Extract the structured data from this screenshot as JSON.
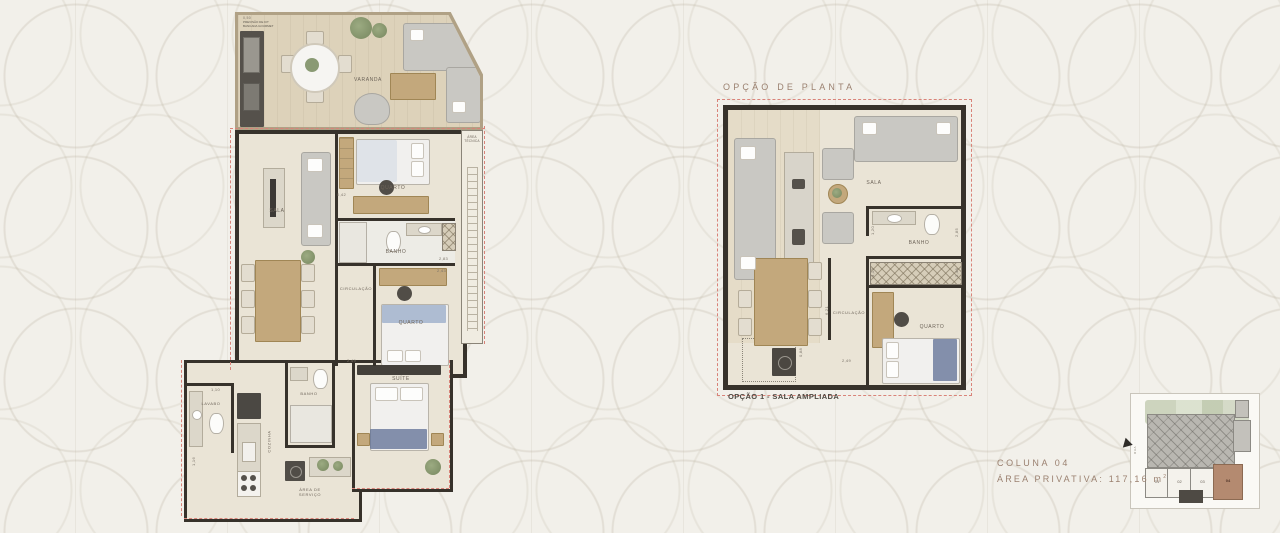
{
  "colors": {
    "background": "#f2f0ea",
    "wall": "#37322b",
    "floor": "#eae4d6",
    "deck": "#ddd2ba",
    "dashed_boundary": "#d98379",
    "furniture_gray": "#c9c8c3",
    "wood": "#c3a87c",
    "title_text": "#9b8170",
    "caption_text": "#4f4a43",
    "site_highlight": "#b48a70",
    "bed_accent": "#5d6f94",
    "plant_green": "#8a9a74"
  },
  "header": {
    "option_title": "OPÇÃO DE PLANTA"
  },
  "left_plan": {
    "note_dimension": "0,50",
    "note_line1": "PREVISÃO DE KIT",
    "note_line2": "BANCADA GOURMET",
    "rooms": {
      "varanda": "VARANDA",
      "sala": "SALA",
      "quarto1": "QUARTO",
      "banho1": "BANHO",
      "area_tecnica_line1": "ÁREA",
      "area_tecnica_line2": "TÉCNICA",
      "circulacao": "CIRCULAÇÃO",
      "quarto2": "QUARTO",
      "suite": "SUÍTE",
      "lavabo": "LAVABO",
      "cozinha": "COZINHA",
      "banho2": "BANHO",
      "area_servico_line1": "ÁREA DE",
      "area_servico_line2": "SERVIÇO"
    },
    "dimensions": {
      "d1": "0,42",
      "d2": "2,43",
      "d3": "2,49",
      "d4": "1,10",
      "d5": "1,16",
      "d6": "2,83"
    }
  },
  "right_plan": {
    "caption": "OPÇÃO 1 - SALA AMPLIADA",
    "rooms": {
      "sala": "SALA",
      "banho": "BANHO",
      "circulacao": "CIRCULAÇÃO",
      "quarto": "QUARTO"
    },
    "dimensions": {
      "d1": "1,20",
      "d2": "3,12",
      "d3": "2,85",
      "d4": "2,48",
      "d5": "6,21",
      "d6": "0,88",
      "d7": "2,49"
    }
  },
  "unit_info": {
    "column_label": "COLUNA 04",
    "area_label": "ÁREA PRIVATIVA: 117,16 m",
    "area_sup": "2"
  },
  "site_plan": {
    "units": [
      "01",
      "02",
      "03",
      "04"
    ],
    "street_label": "RUA"
  }
}
